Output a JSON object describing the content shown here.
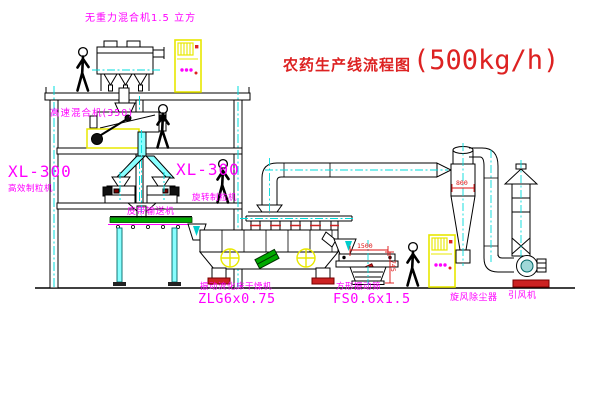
{
  "title": {
    "zh": "农药生产线流程图",
    "capacity": "(500kg/h)"
  },
  "equipment_labels": {
    "gravity_mixer": "无重力混合机1.5 立方",
    "high_speed_mixer": "高速混合机(350)",
    "granulator_left": {
      "model": "XL-300",
      "name": "高效制粒机"
    },
    "granulator_right": {
      "model": "XL-300",
      "name": "旋转制粒机"
    },
    "belt_conveyor": "皮带输送机",
    "fluid_bed_dryer": {
      "name": "振动流化床干燥机",
      "model": "ZLG6x0.75"
    },
    "vibrating_screen": {
      "name": "方形振动筛",
      "model": "FS0.6x1.5"
    },
    "cyclone": "旋风除尘器",
    "induced_draft_fan": "引风机"
  },
  "dimensions": {
    "screen_length": "1500",
    "screen_height": "745",
    "cyclone_diameter": "800"
  },
  "colors": {
    "label_magenta": "#ff00ff",
    "title_red": "#dd2222",
    "centerline_cyan": "#00dcdc",
    "highlight_yellow": "#e8e800",
    "conveyor_green": "#00aa00",
    "foot_pad_red": "#cc2222",
    "line_black": "#000000"
  }
}
